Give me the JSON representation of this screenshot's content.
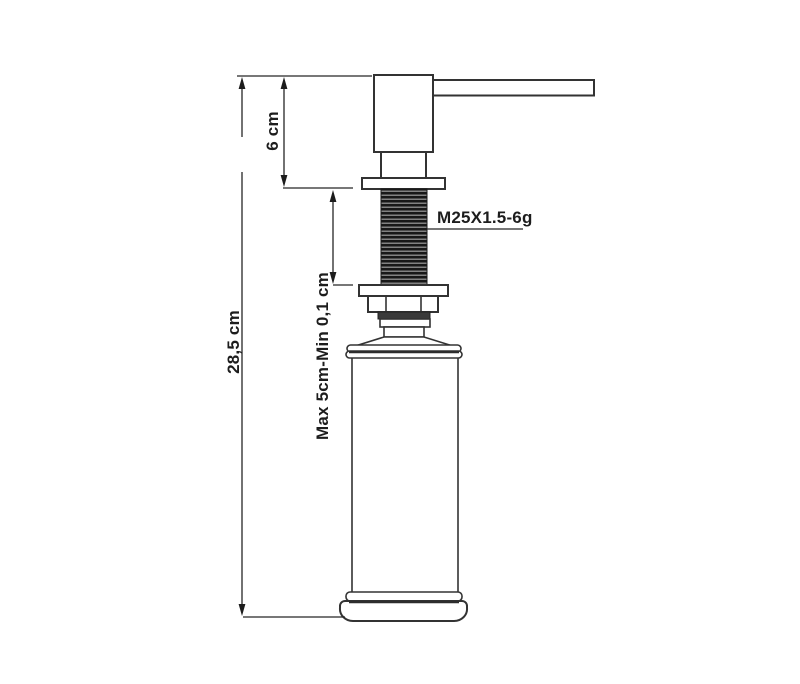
{
  "drawing": {
    "labels": {
      "total_height": "28,5 cm",
      "pump_height": "6 cm",
      "thread_adjust_range": "Max 5cm-Min 0,1 cm",
      "thread_spec": "M25X1.5-6g"
    },
    "colors": {
      "background": "#ffffff",
      "line": "#333333",
      "dimension_line": "#262626",
      "text": "#1d1d1d",
      "thread_dark": "#181818"
    }
  }
}
